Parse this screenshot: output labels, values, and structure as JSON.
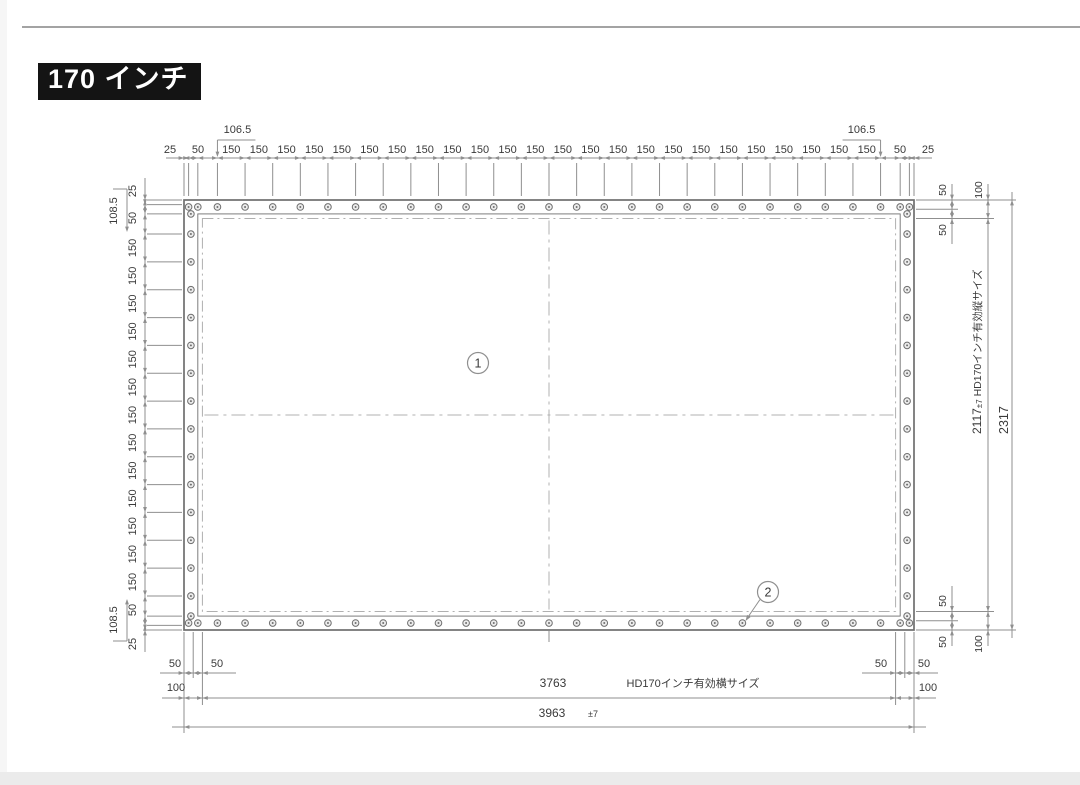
{
  "page": {
    "background": "#ffffff",
    "top_rule_color": "#a3a3a3",
    "bottom_band_color": "#ebebeb"
  },
  "title": {
    "text": "170 インチ",
    "bg": "#141414",
    "color": "#ffffff"
  },
  "drawing": {
    "palette": {
      "line": "#6f6f6f",
      "dim": "#8f8f8f",
      "dash": "#b0b0b0",
      "text": "#3a3a3a"
    },
    "screen_mm": {
      "w": 3963,
      "h": 2317,
      "hem": 75,
      "effective_inset": 100
    },
    "top_chain": {
      "edge": [
        "25",
        "50"
      ],
      "offset_label": "106.5",
      "offset": 106.5,
      "pitch": 150,
      "pitch_label": "150",
      "segments": 24
    },
    "left_chain": {
      "edge": [
        "25",
        "50"
      ],
      "offset_label": "108.5",
      "offset": 108.5,
      "pitch": 150,
      "pitch_label": "150",
      "segments": 13
    },
    "right": {
      "sub": [
        "50",
        "50",
        "100"
      ],
      "effective": {
        "value": "2117",
        "tol": "±7",
        "label": "HD170インチ有効縦サイズ"
      },
      "total": "2317"
    },
    "bottom": {
      "sub": [
        "50",
        "50",
        "100"
      ],
      "effective": {
        "value": "3763",
        "label": "HD170インチ有効横サイズ"
      },
      "total": {
        "value": "3963",
        "tol": "±7"
      }
    },
    "callouts": [
      {
        "num": "1"
      },
      {
        "num": "2"
      }
    ]
  }
}
